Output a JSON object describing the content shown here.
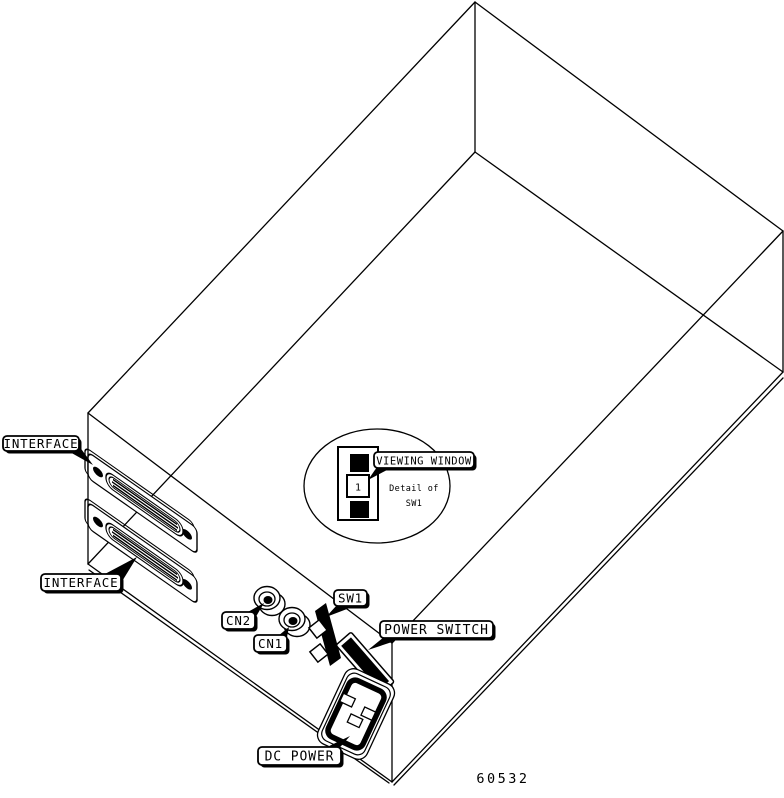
{
  "figure": {
    "caption_number": "60532"
  },
  "callouts": {
    "interface_top": "INTERFACE",
    "interface_bottom": "INTERFACE",
    "cn2": "CN2",
    "cn1": "CN1",
    "sw1": "SW1",
    "power_switch": "POWER SWITCH",
    "dc_power": "DC POWER",
    "viewing_window": "VIEWING WINDOW"
  },
  "detail_inset": {
    "line1": "Detail of",
    "line2": "SW1",
    "switch_position": "1"
  },
  "colors": {
    "line": "#000000",
    "background": "#ffffff"
  }
}
